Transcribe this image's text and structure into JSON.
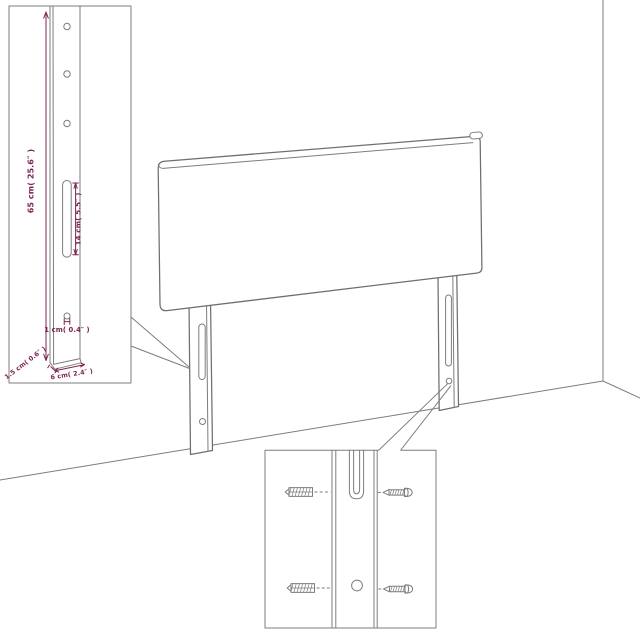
{
  "diagram": {
    "dimensions": {
      "height": "65 cm( 25.6″ )",
      "slot": "14 cm( 5.5″ )",
      "hole": "1 cm( 0.4″ )",
      "thickness": "1.5 cm( 0.6″ )",
      "width": "6 cm( 2.4″ )"
    },
    "colors": {
      "line": "#6f6f6f",
      "dimension_text": "#7e2452",
      "background": "#ffffff"
    },
    "icons": {
      "anchor": "screw-hatched-icon",
      "screw": "screw-side-icon"
    }
  }
}
